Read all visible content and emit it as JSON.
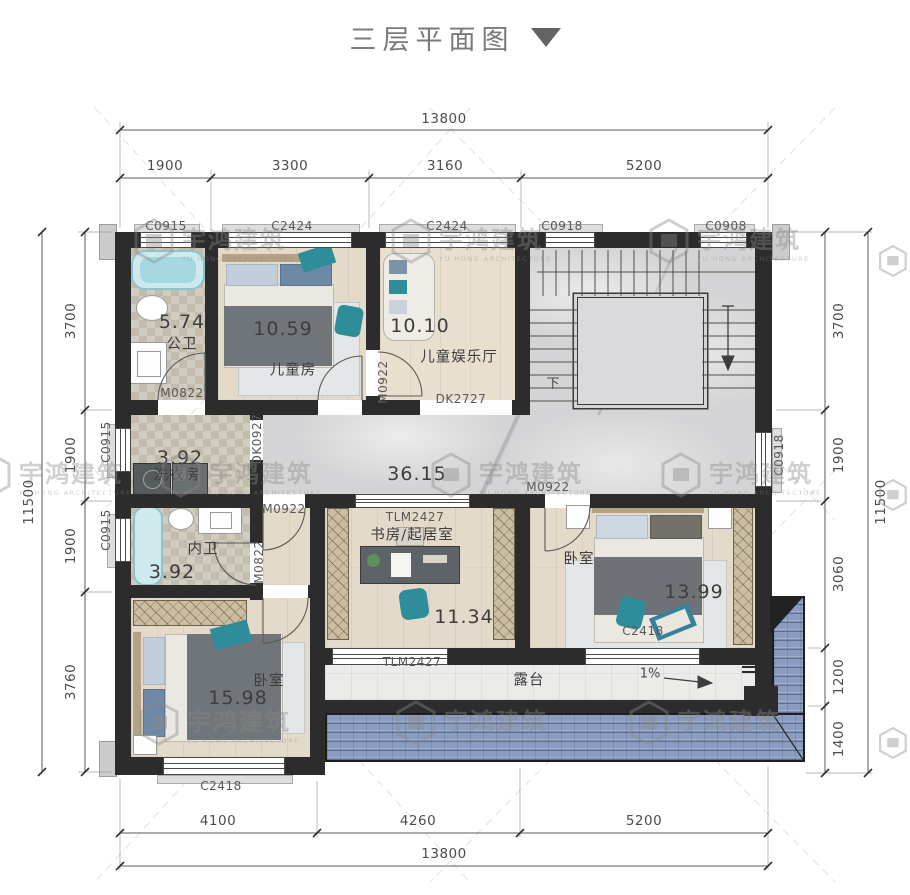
{
  "title": "三层平面图",
  "watermark": {
    "cn": "宇鸿建筑",
    "en": "YU HONG ARCHITECTURE"
  },
  "colors": {
    "wall": "#2c2c2c",
    "accent_teal": "#2f8d9a",
    "roof_blue": "#8a9dc1",
    "dim_text": "#4c4c4c"
  },
  "dims": {
    "top": {
      "overall": "13800",
      "segments": [
        "1900",
        "3300",
        "3160",
        "5200"
      ]
    },
    "bottom": {
      "overall": "13800",
      "segments": [
        "4100",
        "4260",
        "5200"
      ]
    },
    "left": {
      "overall": "11500",
      "segments": [
        "3700",
        "1900",
        "1900",
        "3760"
      ]
    },
    "right": {
      "overall": "11500",
      "segments": [
        "3700",
        "1900",
        "3060",
        "1200",
        "1400"
      ]
    }
  },
  "windows": {
    "top": [
      "C0915",
      "C2424",
      "C2424",
      "C0918",
      "C0908"
    ],
    "left": [
      "C0915",
      "C0915"
    ],
    "right": "C0918",
    "bottom_left": "C2418",
    "bottom_right": "C2418"
  },
  "doors": {
    "bath_public": "M0822",
    "ensuite": "M0822",
    "playroom": "M0922",
    "hall_mid": "M0922",
    "bedroom_right": "M0922",
    "laundry_opening": "DK0927",
    "play_opening": "DK2727",
    "study_sliding": "TLM2427",
    "terrace_sliding": "TLM2427"
  },
  "rooms": {
    "public_bath": {
      "area": "5.74",
      "name": "公卫"
    },
    "kids_room": {
      "area": "10.59",
      "name": "儿童房"
    },
    "kids_play": {
      "area": "10.10",
      "name": "儿童娱乐厅"
    },
    "laundry": {
      "area": "3.92",
      "name": "洗衣房"
    },
    "ensuite_bath": {
      "area": "3.92",
      "name": "内卫"
    },
    "hall": {
      "area": "36.15"
    },
    "study": {
      "area": "11.34",
      "name": "书房/起居室"
    },
    "bedroom_right": {
      "area": "13.99",
      "name": "卧室"
    },
    "bedroom_left": {
      "area": "15.98",
      "name": "卧室"
    },
    "terrace": {
      "name": "露台"
    },
    "stairs": {
      "down_label": "下"
    },
    "slope": {
      "label": "1%"
    }
  }
}
